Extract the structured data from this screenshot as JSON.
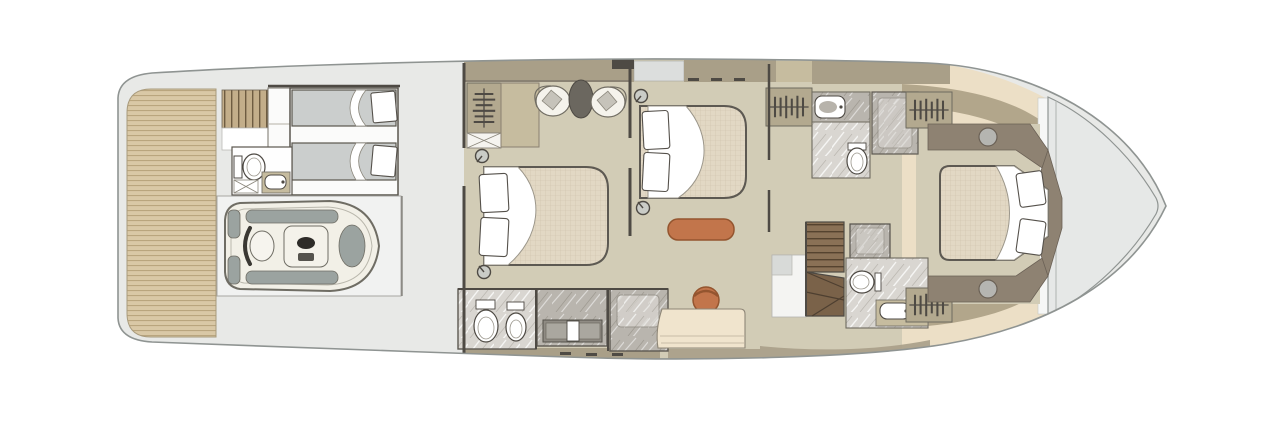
{
  "meta": {
    "type": "yacht-deck-floor-plan",
    "view": "top-down",
    "description": "Top-down lower deck floor plan of a motor yacht: teak swim platform and tender garage with personal watercraft aft, crew cabin with twin berths, two double guest cabins amidships with ensuite bathrooms, companionway stairs, and a forward VIP cabin in the bow"
  },
  "colors": {
    "page_bg": "#ffffff",
    "hull": "#e8e9e7",
    "hull_stroke": "#8f9492",
    "teak": "#d9c8a6",
    "teak_line": "#b9a57e",
    "wall_taupe": "#a99f88",
    "wall_dark": "#4e4a44",
    "taupe_light": "#c6bc9f",
    "floor": "#d2ccb6",
    "mattress": "#e2d8c4",
    "mattress_line": "#b9a88e",
    "crew_bed": "#cbcecd",
    "room_white": "#fbfbfa",
    "marble_light": "#d9d6d1",
    "marble_dark": "#b9b5ae",
    "orange": "#c2754b",
    "orange_stroke": "#94552f",
    "wood": "#8a7156",
    "wood_dark": "#55432f",
    "stair_tan": "#c3ae8a",
    "stair_tan_line": "#6e5c41",
    "cream": "#ecdfc6",
    "tan_band": "#b2a68b",
    "brown": "#8e8272",
    "pad_gray": "#9ba3a0",
    "deck": "#e6e8e7",
    "sofa": "#f0e4cd",
    "dark_obj": "#6b675f"
  },
  "areas": [
    {
      "id": "swim-platform",
      "feature": "teak swim platform aft"
    },
    {
      "id": "aft-stairs",
      "feature": "steps down to swim platform"
    },
    {
      "id": "crew-cabin",
      "feature": "crew cabin with two single berths"
    },
    {
      "id": "crew-bathroom",
      "feature": "crew WC with toilet, washbasin and locker"
    },
    {
      "id": "tender-garage",
      "feature": "tender garage holding a personal watercraft"
    },
    {
      "id": "guest-cabin-mid",
      "feature": "double guest cabin with wardrobe, dresser, two armchairs and pouf"
    },
    {
      "id": "guest-bathroom",
      "feature": "ensuite with toilet, bidet, vanity basin and shower"
    },
    {
      "id": "master-cabin",
      "feature": "double cabin with foot bench, armchair and sofa"
    },
    {
      "id": "fore-bathroom-upper",
      "feature": "bathroom with washbasin, toilet and shower"
    },
    {
      "id": "fore-bathroom-lower",
      "feature": "bathroom with toilet, washbasin and shower box"
    },
    {
      "id": "companionway-stairs",
      "feature": "winding staircase to deck above"
    },
    {
      "id": "wardrobes",
      "feature": "hanging wardrobes along passage and cabins"
    },
    {
      "id": "vip-cabin",
      "feature": "forward VIP cabin with island double bed and side consoles"
    },
    {
      "id": "bow-deck",
      "feature": "pointed bow deck"
    }
  ]
}
